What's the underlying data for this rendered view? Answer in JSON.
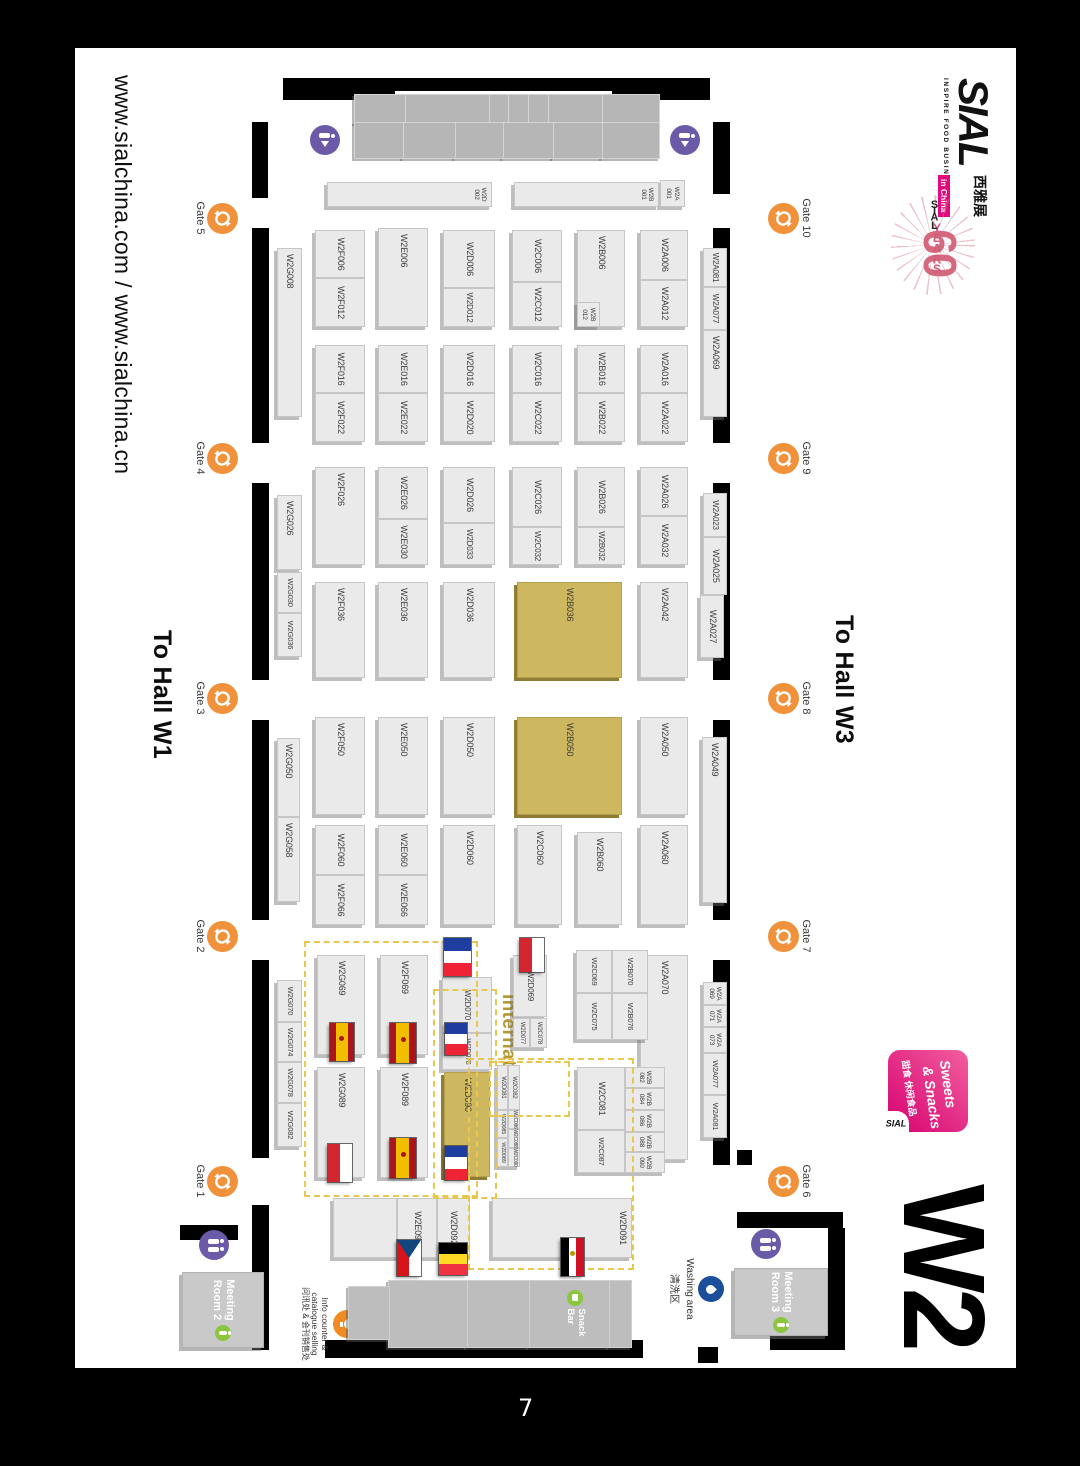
{
  "page": {
    "number": "7",
    "url": "www.sialchina.com / www.sialchina.cn",
    "hall": "W2",
    "to_hall_left": "To Hall W1",
    "to_hall_right": "To Hall W3"
  },
  "branding": {
    "sial": "SIAL",
    "tagline": "INSPIRE FOOD BUSINESS",
    "chinese": "西雅展",
    "in_china": "in China",
    "years_60": "60",
    "years_label": "YEARS",
    "years_sial": "SIAL",
    "sweets": {
      "line1": "Sweets",
      "line2": "& Snacks",
      "cn": "甜食 休闲食品",
      "sial": "SIAL"
    }
  },
  "areas": {
    "international": "International Area",
    "snack_bar": "Snack\nBar",
    "meeting_room_2": "Meeting\nRoom 2",
    "meeting_room_3": "Meeting\nRoom 3",
    "washing_en": "Washing area",
    "washing_cn": "清洗区",
    "info_en1": "Info counter &",
    "info_en2": "catalogue selling",
    "info_cn": "问讯处 & 会刊销售处"
  },
  "colors": {
    "booth_gold": "#cdb75f",
    "gate_orange": "#f0923b",
    "restroom_purple": "#6a5aa8",
    "green": "#8cc63e",
    "washing_blue": "#1b4e9b",
    "pink": "#e3097e",
    "dashed_gold": "#e9c64d",
    "intl_text": "#b5992f"
  },
  "map": {
    "gates": [
      {
        "label": "Gate 5",
        "x": 170,
        "side": "bottom"
      },
      {
        "label": "Gate 4",
        "x": 410,
        "side": "bottom"
      },
      {
        "label": "Gate 3",
        "x": 650,
        "side": "bottom"
      },
      {
        "label": "Gate 2",
        "x": 888,
        "side": "bottom"
      },
      {
        "label": "Gate 1",
        "x": 1133,
        "side": "bottom"
      },
      {
        "label": "Gate 10",
        "x": 170,
        "side": "top"
      },
      {
        "label": "Gate 9",
        "x": 410,
        "side": "top"
      },
      {
        "label": "Gate 8",
        "x": 650,
        "side": "top"
      },
      {
        "label": "Gate 7",
        "x": 888,
        "side": "top"
      },
      {
        "label": "Gate 6",
        "x": 1133,
        "side": "top"
      }
    ],
    "restrooms": [
      {
        "x": 92,
        "y": 331,
        "type": "entry"
      },
      {
        "x": 92,
        "y": 691,
        "type": "entry"
      },
      {
        "x": 1197,
        "y": 802,
        "type": "wc"
      },
      {
        "x": 1196,
        "y": 250,
        "type": "wc"
      }
    ],
    "flags": [
      {
        "country": "france",
        "x": 890,
        "y": 545,
        "w": 38,
        "h": 27
      },
      {
        "country": "france",
        "x": 975,
        "y": 549,
        "w": 32,
        "h": 22
      },
      {
        "country": "france",
        "x": 1098,
        "y": 549,
        "w": 34,
        "h": 22
      },
      {
        "country": "poland",
        "x": 890,
        "y": 472,
        "w": 34,
        "h": 24
      },
      {
        "country": "spain",
        "x": 975,
        "y": 600,
        "w": 40,
        "h": 26
      },
      {
        "country": "spain",
        "x": 1090,
        "y": 600,
        "w": 40,
        "h": 26
      },
      {
        "country": "spain",
        "x": 975,
        "y": 662,
        "w": 38,
        "h": 24
      },
      {
        "country": "poland",
        "x": 1096,
        "y": 664,
        "w": 38,
        "h": 24
      },
      {
        "country": "czech",
        "x": 1192,
        "y": 595,
        "w": 36,
        "h": 24
      },
      {
        "country": "belgium",
        "x": 1195,
        "y": 549,
        "w": 32,
        "h": 28
      },
      {
        "country": "egypt",
        "x": 1190,
        "y": 432,
        "w": 38,
        "h": 23
      }
    ],
    "booths": [
      {
        "l": "W2A081",
        "x": 200,
        "y": 289,
        "w": 39,
        "h": 24,
        "fs": 8
      },
      {
        "l": "W2A077",
        "x": 239,
        "y": 289,
        "w": 43,
        "h": 24,
        "fs": 8
      },
      {
        "l": "W2A069",
        "x": 282,
        "y": 289,
        "w": 87,
        "h": 24
      },
      {
        "l": "W2A023",
        "x": 445,
        "y": 289,
        "w": 44,
        "h": 24,
        "fs": 8
      },
      {
        "l": "W2A025",
        "x": 489,
        "y": 289,
        "w": 58,
        "h": 24
      },
      {
        "l": "W2A027",
        "x": 547,
        "y": 292,
        "w": 63,
        "h": 24
      },
      {
        "l": "W2A049",
        "x": 689,
        "y": 289,
        "w": 166,
        "h": 25
      },
      {
        "l": "W2A\n069",
        "x": 934,
        "y": 289,
        "w": 23,
        "h": 24,
        "fs": 6.5
      },
      {
        "l": "W2A\n071",
        "x": 957,
        "y": 289,
        "w": 22,
        "h": 24,
        "fs": 6.5
      },
      {
        "l": "W2A\n073",
        "x": 979,
        "y": 289,
        "w": 26,
        "h": 24,
        "fs": 6.5
      },
      {
        "l": "W2A077",
        "x": 1005,
        "y": 289,
        "w": 42,
        "h": 24,
        "fs": 7.5
      },
      {
        "l": "W2A081",
        "x": 1047,
        "y": 289,
        "w": 43,
        "h": 24,
        "fs": 7.5
      },
      {
        "l": "W2A006",
        "x": 182,
        "y": 328,
        "w": 50,
        "h": 48
      },
      {
        "l": "W2A012",
        "x": 232,
        "y": 328,
        "w": 47,
        "h": 48
      },
      {
        "l": "W2A016",
        "x": 297,
        "y": 328,
        "w": 48,
        "h": 48
      },
      {
        "l": "W2A022",
        "x": 345,
        "y": 328,
        "w": 49,
        "h": 48
      },
      {
        "l": "W2A026",
        "x": 419,
        "y": 328,
        "w": 49,
        "h": 48
      },
      {
        "l": "W2A032",
        "x": 468,
        "y": 328,
        "w": 49,
        "h": 48
      },
      {
        "l": "W2A042",
        "x": 534,
        "y": 328,
        "w": 96,
        "h": 48
      },
      {
        "l": "W2A050",
        "x": 669,
        "y": 328,
        "w": 98,
        "h": 48
      },
      {
        "l": "W2A060",
        "x": 777,
        "y": 328,
        "w": 100,
        "h": 48
      },
      {
        "l": "W2A070",
        "x": 907,
        "y": 328,
        "w": 205,
        "h": 48
      },
      {
        "l": "W2B006",
        "x": 182,
        "y": 391,
        "w": 97,
        "h": 48
      },
      {
        "l": "W2B\n012",
        "x": 254,
        "y": 416,
        "w": 25,
        "h": 23,
        "fs": 6.5
      },
      {
        "l": "W2B016",
        "x": 297,
        "y": 391,
        "w": 48,
        "h": 48
      },
      {
        "l": "W2B022",
        "x": 345,
        "y": 391,
        "w": 49,
        "h": 48
      },
      {
        "l": "W2B026",
        "x": 419,
        "y": 391,
        "w": 60,
        "h": 48
      },
      {
        "l": "W2B032",
        "x": 479,
        "y": 391,
        "w": 38,
        "h": 48,
        "fs": 8
      },
      {
        "l": "W2B036",
        "x": 534,
        "y": 394,
        "w": 96,
        "h": 105,
        "gold": 1
      },
      {
        "l": "W2B050",
        "x": 669,
        "y": 394,
        "w": 98,
        "h": 105,
        "gold": 1
      },
      {
        "l": "W2B060",
        "x": 784,
        "y": 394,
        "w": 93,
        "h": 45
      },
      {
        "l": "W2B070",
        "x": 902,
        "y": 368,
        "w": 43,
        "h": 36,
        "fs": 7.5
      },
      {
        "l": "W2B076",
        "x": 945,
        "y": 368,
        "w": 47,
        "h": 36,
        "fs": 7.5
      },
      {
        "l": "W2C069",
        "x": 902,
        "y": 404,
        "w": 43,
        "h": 36,
        "fs": 7.5
      },
      {
        "l": "W2C075",
        "x": 945,
        "y": 404,
        "w": 47,
        "h": 36,
        "fs": 7.5
      },
      {
        "l": "W2B\n082",
        "x": 1019,
        "y": 351,
        "w": 21,
        "h": 40,
        "fs": 6.5
      },
      {
        "l": "W2B\n084",
        "x": 1040,
        "y": 351,
        "w": 22,
        "h": 40,
        "fs": 6.5
      },
      {
        "l": "W2B\n086",
        "x": 1062,
        "y": 351,
        "w": 22,
        "h": 40,
        "fs": 6.5
      },
      {
        "l": "W2B\n088",
        "x": 1084,
        "y": 351,
        "w": 20,
        "h": 40,
        "fs": 6.5
      },
      {
        "l": "W2B\n090",
        "x": 1104,
        "y": 351,
        "w": 21,
        "h": 40,
        "fs": 6.5
      },
      {
        "l": "W2C081",
        "x": 1019,
        "y": 391,
        "w": 63,
        "h": 48
      },
      {
        "l": "W2C087",
        "x": 1082,
        "y": 391,
        "w": 43,
        "h": 48,
        "fs": 7.5
      },
      {
        "l": "W2C006",
        "x": 182,
        "y": 454,
        "w": 52,
        "h": 50
      },
      {
        "l": "W2C012",
        "x": 234,
        "y": 454,
        "w": 45,
        "h": 50
      },
      {
        "l": "W2C016",
        "x": 297,
        "y": 454,
        "w": 48,
        "h": 50
      },
      {
        "l": "W2C022",
        "x": 345,
        "y": 454,
        "w": 49,
        "h": 50
      },
      {
        "l": "W2C026",
        "x": 419,
        "y": 454,
        "w": 60,
        "h": 50
      },
      {
        "l": "W2C032",
        "x": 479,
        "y": 454,
        "w": 38,
        "h": 50,
        "fs": 8
      },
      {
        "l": "W2C060",
        "x": 777,
        "y": 454,
        "w": 100,
        "h": 45
      },
      {
        "l": "W2D069",
        "x": 907,
        "y": 469,
        "w": 62,
        "h": 34,
        "fs": 8
      },
      {
        "l": "W2C078",
        "x": 970,
        "y": 469,
        "w": 30,
        "h": 17,
        "fs": 6
      },
      {
        "l": "W2D077",
        "x": 970,
        "y": 486,
        "w": 30,
        "h": 17,
        "fs": 6
      },
      {
        "l": "W2C082",
        "x": 1017,
        "y": 496,
        "w": 45,
        "h": 12,
        "fs": 6
      },
      {
        "l": "W2D081",
        "x": 1017,
        "y": 508,
        "w": 45,
        "h": 11,
        "fs": 6
      },
      {
        "l": "W2C086",
        "x": 1062,
        "y": 496,
        "w": 19,
        "h": 12,
        "fs": 5
      },
      {
        "l": "W2C088",
        "x": 1081,
        "y": 496,
        "w": 19,
        "h": 12,
        "fs": 5
      },
      {
        "l": "W2C090",
        "x": 1100,
        "y": 496,
        "w": 19,
        "h": 12,
        "fs": 5
      },
      {
        "l": "W2D085",
        "x": 1062,
        "y": 508,
        "w": 28,
        "h": 11,
        "fs": 5.5
      },
      {
        "l": "W2D089",
        "x": 1090,
        "y": 508,
        "w": 29,
        "h": 11,
        "fs": 5.5
      },
      {
        "l": "W2D006",
        "x": 182,
        "y": 521,
        "w": 58,
        "h": 52
      },
      {
        "l": "W2D012",
        "x": 240,
        "y": 521,
        "w": 39,
        "h": 52,
        "fs": 8
      },
      {
        "l": "W2D016",
        "x": 297,
        "y": 521,
        "w": 48,
        "h": 52
      },
      {
        "l": "W2D020",
        "x": 345,
        "y": 521,
        "w": 49,
        "h": 52
      },
      {
        "l": "W2D026",
        "x": 419,
        "y": 521,
        "w": 56,
        "h": 52
      },
      {
        "l": "W2D033",
        "x": 475,
        "y": 521,
        "w": 42,
        "h": 52,
        "fs": 8
      },
      {
        "l": "W2D036",
        "x": 534,
        "y": 521,
        "w": 96,
        "h": 52
      },
      {
        "l": "W2D050",
        "x": 669,
        "y": 521,
        "w": 98,
        "h": 52
      },
      {
        "l": "W2D060",
        "x": 777,
        "y": 521,
        "w": 100,
        "h": 52
      },
      {
        "l": "W2D070",
        "x": 929,
        "y": 524,
        "w": 56,
        "h": 50,
        "fs": 8
      },
      {
        "l": "W2D078",
        "x": 985,
        "y": 524,
        "w": 37,
        "h": 50,
        "fs": 7
      },
      {
        "l": "W2D090",
        "x": 1024,
        "y": 526,
        "w": 105,
        "h": 46,
        "gold": 1
      },
      {
        "l": "W2D091",
        "x": 1150,
        "y": 384,
        "w": 60,
        "h": 140,
        "top": 1
      },
      {
        "l": "W2D092",
        "x": 1150,
        "y": 546,
        "w": 60,
        "h": 33
      },
      {
        "l": "W2E092",
        "x": 1150,
        "y": 579,
        "w": 60,
        "h": 40
      },
      {
        "l": "",
        "x": 1150,
        "y": 619,
        "w": 60,
        "h": 64
      },
      {
        "l": "W2E006",
        "x": 180,
        "y": 588,
        "w": 99,
        "h": 50
      },
      {
        "l": "W2E016",
        "x": 297,
        "y": 588,
        "w": 48,
        "h": 50
      },
      {
        "l": "W2E022",
        "x": 345,
        "y": 588,
        "w": 49,
        "h": 50
      },
      {
        "l": "W2E026",
        "x": 419,
        "y": 588,
        "w": 52,
        "h": 50
      },
      {
        "l": "W2E030",
        "x": 471,
        "y": 588,
        "w": 46,
        "h": 50
      },
      {
        "l": "W2E036",
        "x": 534,
        "y": 588,
        "w": 96,
        "h": 50
      },
      {
        "l": "W2E050",
        "x": 669,
        "y": 588,
        "w": 98,
        "h": 50
      },
      {
        "l": "W2E060",
        "x": 777,
        "y": 588,
        "w": 50,
        "h": 50
      },
      {
        "l": "W2E066",
        "x": 827,
        "y": 588,
        "w": 50,
        "h": 50
      },
      {
        "l": "W2F069",
        "x": 907,
        "y": 588,
        "w": 100,
        "h": 48
      },
      {
        "l": "W2F089",
        "x": 1019,
        "y": 588,
        "w": 111,
        "h": 48
      },
      {
        "l": "W2F006",
        "x": 182,
        "y": 651,
        "w": 48,
        "h": 50
      },
      {
        "l": "W2F012",
        "x": 230,
        "y": 651,
        "w": 49,
        "h": 50
      },
      {
        "l": "W2F016",
        "x": 297,
        "y": 651,
        "w": 48,
        "h": 50
      },
      {
        "l": "W2F022",
        "x": 345,
        "y": 651,
        "w": 49,
        "h": 50
      },
      {
        "l": "W2F026",
        "x": 419,
        "y": 651,
        "w": 98,
        "h": 50
      },
      {
        "l": "W2F036",
        "x": 534,
        "y": 651,
        "w": 96,
        "h": 50
      },
      {
        "l": "W2F050",
        "x": 669,
        "y": 651,
        "w": 98,
        "h": 50
      },
      {
        "l": "W2F060",
        "x": 777,
        "y": 651,
        "w": 50,
        "h": 50
      },
      {
        "l": "W2F066",
        "x": 827,
        "y": 651,
        "w": 50,
        "h": 50
      },
      {
        "l": "W2G069",
        "x": 907,
        "y": 651,
        "w": 100,
        "h": 48
      },
      {
        "l": "W2G089",
        "x": 1019,
        "y": 651,
        "w": 111,
        "h": 48
      },
      {
        "l": "W2G008",
        "x": 200,
        "y": 714,
        "w": 169,
        "h": 25
      },
      {
        "l": "W2G026",
        "x": 447,
        "y": 714,
        "w": 75,
        "h": 25
      },
      {
        "l": "W2G030",
        "x": 524,
        "y": 714,
        "w": 41,
        "h": 25,
        "fs": 7.5
      },
      {
        "l": "W2G036",
        "x": 565,
        "y": 714,
        "w": 44,
        "h": 25,
        "fs": 7.5
      },
      {
        "l": "W2G050",
        "x": 690,
        "y": 716,
        "w": 79,
        "h": 23
      },
      {
        "l": "W2G058",
        "x": 769,
        "y": 716,
        "w": 85,
        "h": 23
      },
      {
        "l": "W2G070",
        "x": 932,
        "y": 714,
        "w": 42,
        "h": 25,
        "fs": 7.5
      },
      {
        "l": "W2G074",
        "x": 974,
        "y": 714,
        "w": 40,
        "h": 25,
        "fs": 7.5
      },
      {
        "l": "W2G078",
        "x": 1014,
        "y": 714,
        "w": 41,
        "h": 25,
        "fs": 7.5
      },
      {
        "l": "W2G082",
        "x": 1055,
        "y": 714,
        "w": 44,
        "h": 25,
        "fs": 7.5
      },
      {
        "l": "W2A\n001",
        "x": 132,
        "y": 331,
        "w": 27,
        "h": 25,
        "fs": 6.5
      },
      {
        "l": "W2B\n001",
        "x": 134,
        "y": 357,
        "w": 25,
        "h": 145,
        "fs": 6.5,
        "top": 1
      },
      {
        "l": "W2D\n002",
        "x": 134,
        "y": 524,
        "w": 25,
        "h": 165,
        "fs": 6.5,
        "top": 1
      }
    ]
  }
}
